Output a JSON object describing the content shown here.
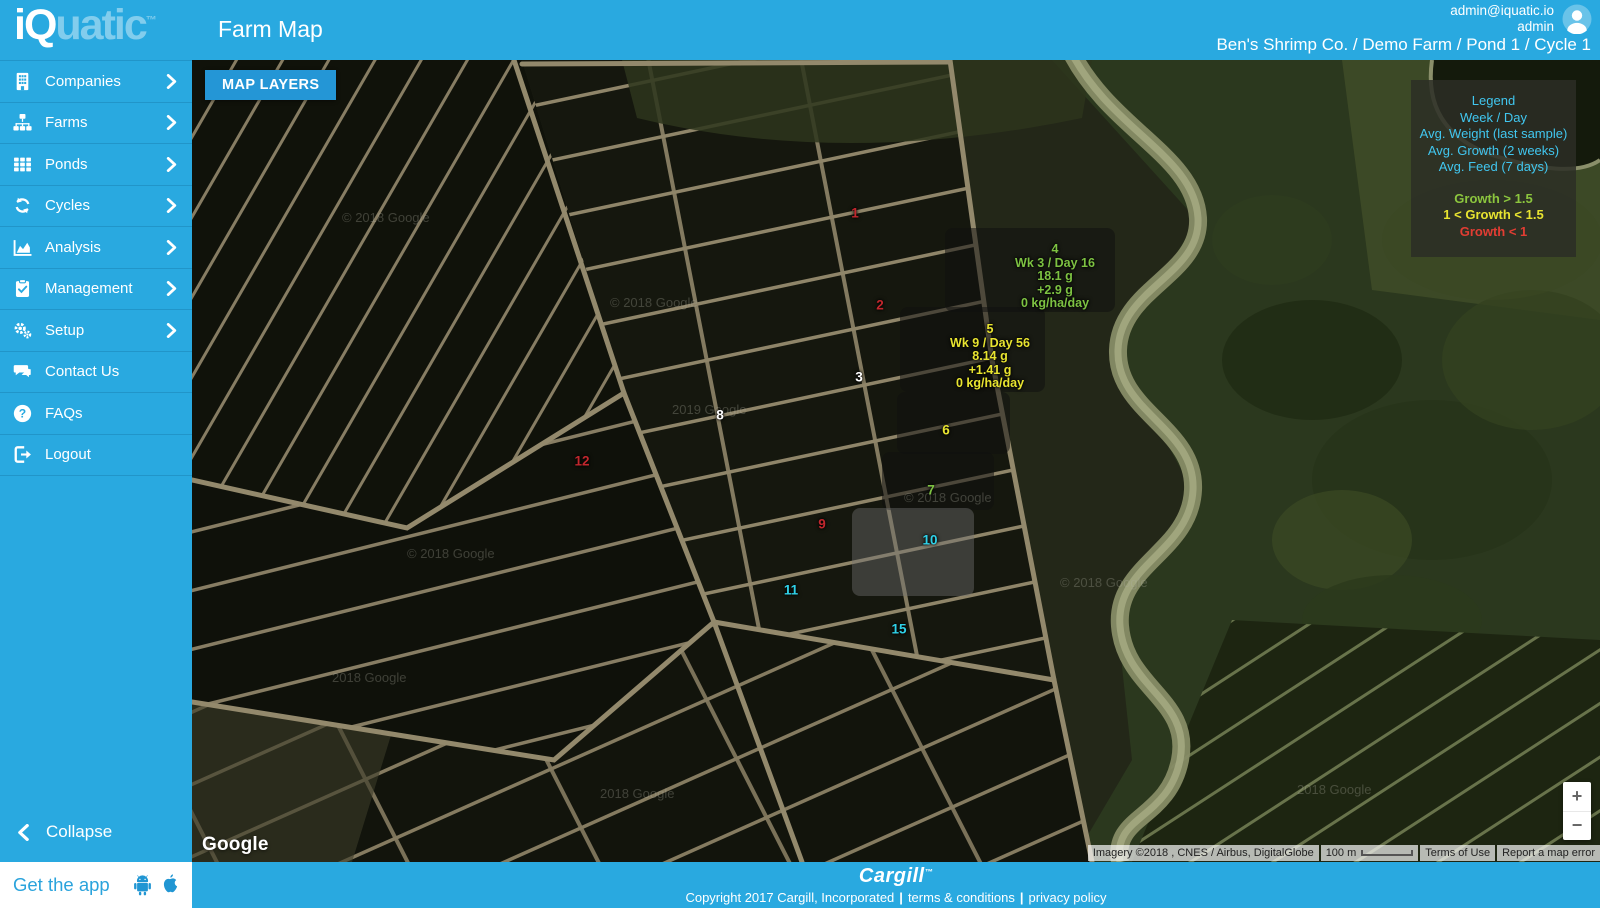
{
  "header": {
    "logo_primary": "iQ",
    "logo_secondary": "uatic",
    "logo_mark": "™",
    "title": "Farm Map",
    "user_email": "admin@iquatic.io",
    "user_name": "admin",
    "breadcrumb": "Ben's Shrimp Co. / Demo Farm / Pond 1 / Cycle 1"
  },
  "sidebar": {
    "items": [
      {
        "label": "Companies",
        "icon": "building-icon",
        "has_chevron": true
      },
      {
        "label": "Farms",
        "icon": "sitemap-icon",
        "has_chevron": true
      },
      {
        "label": "Ponds",
        "icon": "grid-icon",
        "has_chevron": true
      },
      {
        "label": "Cycles",
        "icon": "refresh-icon",
        "has_chevron": true
      },
      {
        "label": "Analysis",
        "icon": "chart-icon",
        "has_chevron": true
      },
      {
        "label": "Management",
        "icon": "clipboard-icon",
        "has_chevron": true
      },
      {
        "label": "Setup",
        "icon": "gears-icon",
        "has_chevron": true
      },
      {
        "label": "Contact Us",
        "icon": "comments-icon",
        "has_chevron": false
      },
      {
        "label": "FAQs",
        "icon": "question-icon",
        "has_chevron": false
      },
      {
        "label": "Logout",
        "icon": "logout-icon",
        "has_chevron": false
      }
    ],
    "collapse_label": "Collapse",
    "get_app_label": "Get the app"
  },
  "map": {
    "layers_button_label": "MAP LAYERS",
    "legend": {
      "title": "Legend",
      "info_lines": [
        "Week / Day",
        "Avg. Weight (last sample)",
        "Avg. Growth (2 weeks)",
        "Avg. Feed (7 days)"
      ],
      "thresholds": [
        {
          "label": "Growth > 1.5",
          "color": "#8cc63e"
        },
        {
          "label": "1 < Growth < 1.5",
          "color": "#e8e430"
        },
        {
          "label": "Growth < 1",
          "color": "#e23d33"
        }
      ]
    },
    "pond_markers": [
      {
        "number": "1",
        "color": "#c1272d",
        "x": 663,
        "y": 153
      },
      {
        "number": "2",
        "color": "#c1272d",
        "x": 688,
        "y": 245
      },
      {
        "number": "3",
        "color": "#ffffff",
        "x": 667,
        "y": 317
      },
      {
        "number": "8",
        "color": "#ffffff",
        "x": 528,
        "y": 355
      },
      {
        "number": "12",
        "color": "#c1272d",
        "x": 390,
        "y": 401
      },
      {
        "number": "9",
        "color": "#c1272d",
        "x": 630,
        "y": 464
      },
      {
        "number": "6",
        "color": "#e8e430",
        "x": 754,
        "y": 370
      },
      {
        "number": "7",
        "color": "#7dc242",
        "x": 739,
        "y": 430
      },
      {
        "number": "10",
        "color": "#2fd1e8",
        "x": 738,
        "y": 480
      },
      {
        "number": "11",
        "color": "#2fd1e8",
        "x": 599,
        "y": 530
      },
      {
        "number": "15",
        "color": "#2fd1e8",
        "x": 707,
        "y": 569
      }
    ],
    "pond_details": [
      {
        "number": "4",
        "color": "#7dc242",
        "x": 863,
        "y": 183,
        "lines": [
          "Wk 3 / Day 16",
          "18.1 g",
          "+2.9 g",
          "0 kg/ha/day"
        ]
      },
      {
        "number": "5",
        "color": "#e8e430",
        "x": 798,
        "y": 263,
        "lines": [
          "Wk 9 / Day 56",
          "8.14 g",
          "+1.41 g",
          "0 kg/ha/day"
        ]
      }
    ],
    "highlight_areas": [
      {
        "pond": "4",
        "x": 753,
        "y": 168,
        "w": 170,
        "h": 84,
        "shade": "dark"
      },
      {
        "pond": "5",
        "x": 708,
        "y": 247,
        "w": 145,
        "h": 85,
        "shade": "dark"
      },
      {
        "pond": "6",
        "x": 705,
        "y": 332,
        "w": 113,
        "h": 62,
        "shade": "dark"
      },
      {
        "pond": "7",
        "x": 690,
        "y": 392,
        "w": 112,
        "h": 58,
        "shade": "dark"
      },
      {
        "pond": "10",
        "x": 660,
        "y": 448,
        "w": 122,
        "h": 88,
        "shade": "light"
      }
    ],
    "watermarks": [
      {
        "text": "© 2018 Google",
        "x": 150,
        "y": 150
      },
      {
        "text": "© 2018 Google",
        "x": 418,
        "y": 235
      },
      {
        "text": "2019 Google",
        "x": 480,
        "y": 342
      },
      {
        "text": "© 2018 Google",
        "x": 215,
        "y": 486
      },
      {
        "text": "2018 Google",
        "x": 140,
        "y": 610
      },
      {
        "text": "2018 Google",
        "x": 408,
        "y": 726
      },
      {
        "text": "© 2018 Google",
        "x": 712,
        "y": 430
      },
      {
        "text": "© 2018 Google",
        "x": 868,
        "y": 515
      },
      {
        "text": "2018 Google",
        "x": 1105,
        "y": 722
      }
    ],
    "google_label": "Google",
    "attribution": {
      "imagery": "Imagery ©2018 , CNES / Airbus, DigitalGlobe",
      "scale_label": "100 m",
      "terms_label": "Terms of Use",
      "report_label": "Report a map error"
    },
    "zoom_in_label": "+",
    "zoom_out_label": "−"
  },
  "footer": {
    "brand": "Cargill",
    "brand_mark": "™",
    "copyright_text": "Copyright 2017 Cargill, Incorporated",
    "separator": "|",
    "terms_label": "terms & conditions",
    "privacy_label": "privacy policy"
  },
  "colors": {
    "primary_blue": "#29a9e0",
    "legend_cyan": "#41c7f0",
    "growth_green": "#8cc63e",
    "growth_yellow": "#e8e430",
    "growth_red": "#e23d33",
    "marker_cyan": "#2fd1e8",
    "marker_red": "#c1272d"
  }
}
